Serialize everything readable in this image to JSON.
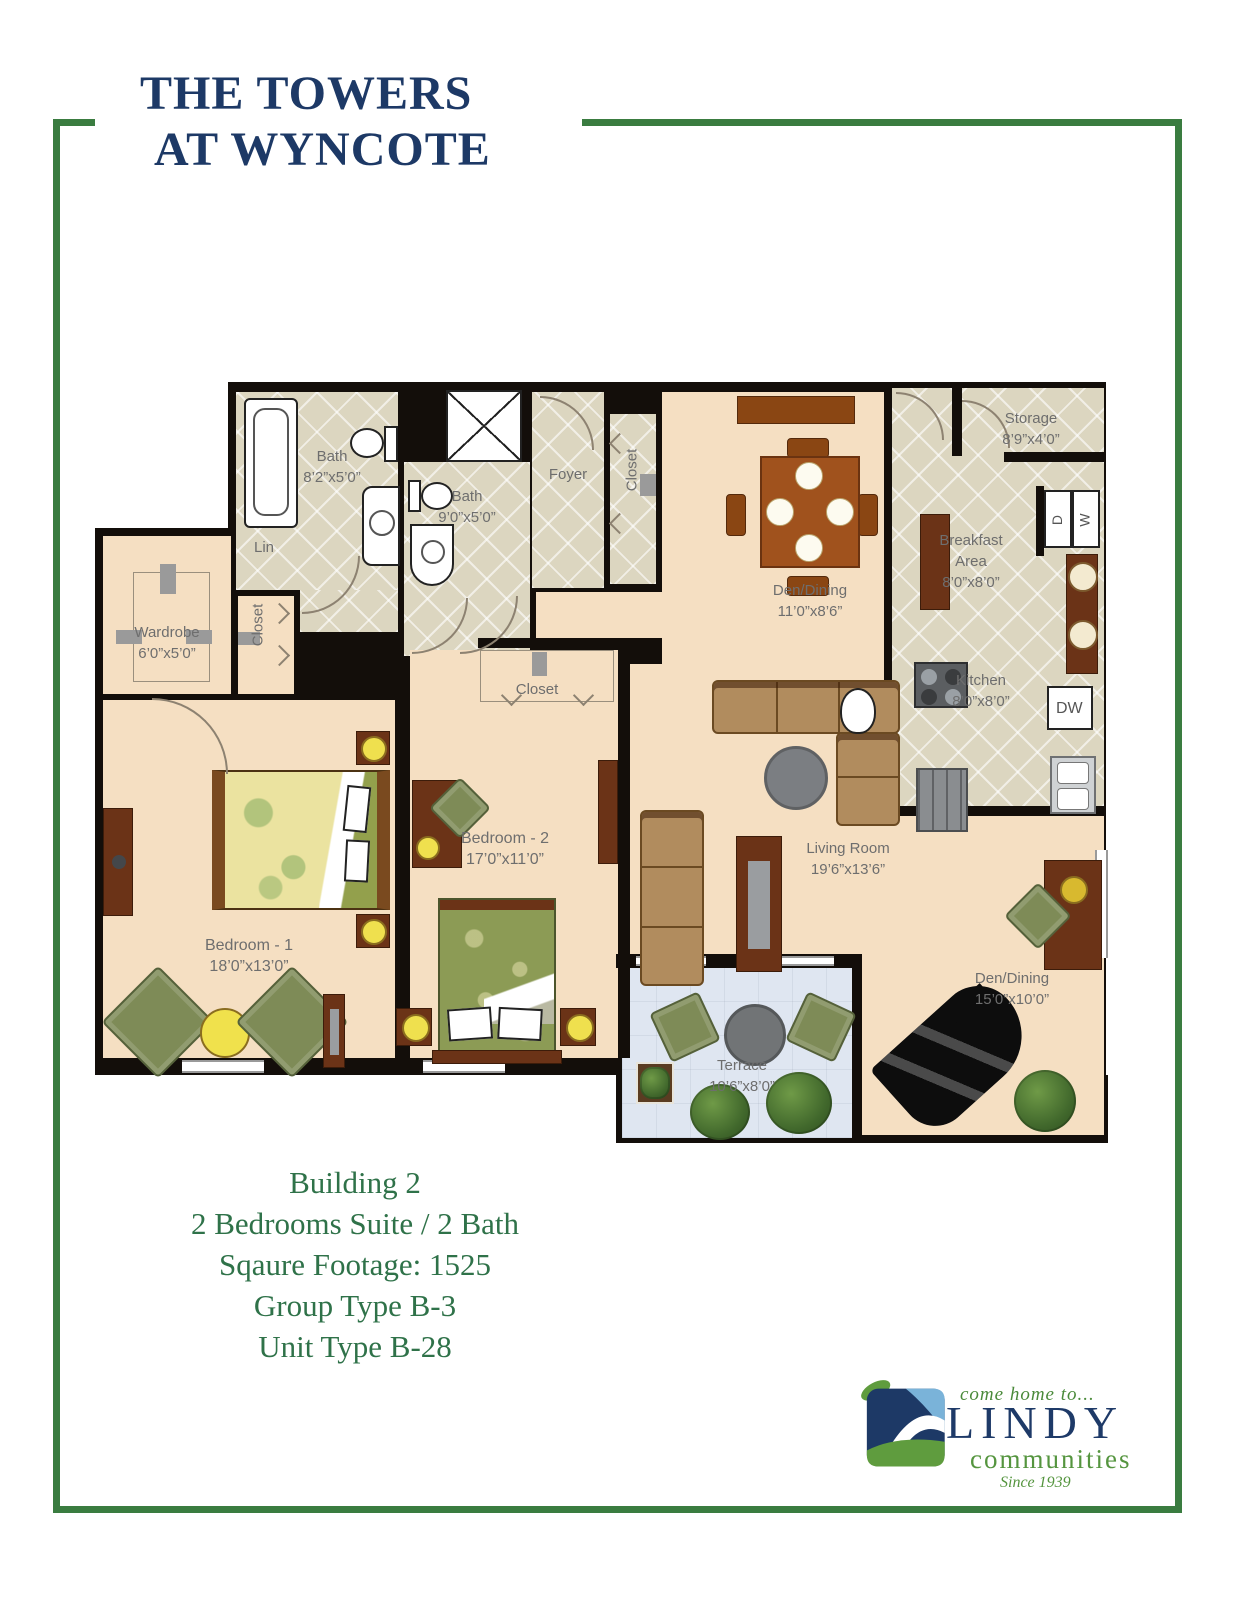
{
  "title": {
    "line1": "THE TOWERS",
    "line2": "AT WYNCOTE"
  },
  "plan": {
    "labels": {
      "bath1": {
        "name": "Bath",
        "dims": "8’2”x5’0”"
      },
      "bath2": {
        "name": "Bath",
        "dims": "9’0”x5’0”"
      },
      "foyer": {
        "name": "Foyer"
      },
      "closet_foyer": {
        "name": "Closet"
      },
      "lin": {
        "name": "Lin"
      },
      "wardrobe": {
        "name": "Wardrobe",
        "dims": "6’0”x5’0”"
      },
      "closet_bedroom1": {
        "name": "Closet"
      },
      "closet_bedroom2": {
        "name": "Closet"
      },
      "storage": {
        "name": "Storage",
        "dims": "8’9”x4’0”"
      },
      "breakfast": {
        "line1": "Breakfast",
        "line2": "Area",
        "dims": "8’0”x8’0”"
      },
      "kitchen": {
        "name": "Kitchen",
        "dims": "8’0”x8’0”"
      },
      "den_upper": {
        "name": "Den/Dining",
        "dims": "11’0”x8’6”"
      },
      "living": {
        "name": "Living Room",
        "dims": "19’6”x13’6”"
      },
      "den_lower": {
        "name": "Den/Dining",
        "dims": "15’0”x10’0”"
      },
      "terrace": {
        "name": "Terrace",
        "dims": "10’6”x8’0”"
      },
      "bedroom1": {
        "name": "Bedroom - 1",
        "dims": "18’0”x13’0”"
      },
      "bedroom2": {
        "name": "Bedroom - 2",
        "dims": "17’0”x11’0”"
      },
      "washer": "W",
      "dryer": "D",
      "dishwasher": "DW"
    }
  },
  "summary": {
    "lines": [
      "Building 2",
      "2 Bedrooms Suite / 2 Bath",
      "Sqaure Footage: 1525",
      "Group Type B-3",
      "Unit Type B-28"
    ]
  },
  "logo": {
    "tagline": "come home to...",
    "name": "LINDY",
    "subtitle": "communities",
    "since": "Since 1939"
  },
  "colors": {
    "frame_green": "#3a7c40",
    "title_navy": "#1d3966",
    "summary_green": "#2f7249",
    "floor_beige": "#f5dfc2",
    "tile": "#dcd6c0",
    "wall_black": "#130e0a",
    "terrace_blue": "#dfe6f1",
    "label_gray": "#6e6e6e"
  }
}
